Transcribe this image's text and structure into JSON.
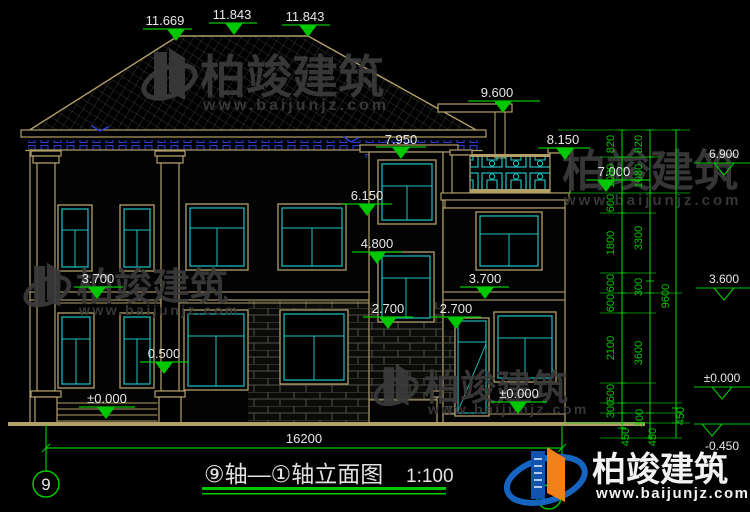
{
  "drawing": {
    "roof_marks": [
      "11.669",
      "11.843",
      "11.843"
    ],
    "elev": {
      "top_right": "9.600",
      "balcony_top": "8.150",
      "balcony_floor": "7.000",
      "tower_top": "7.950",
      "tower_win": "6.150",
      "tower_mid": "4.800",
      "left_floor2": "3.700",
      "wing_floor2": "3.700",
      "tower_sill": "2.700",
      "wing_sill": "2.700",
      "porch_cap": "0.500",
      "porch_zero": "±0.000",
      "wing_zero": "±0.000",
      "right_6900": "6.900",
      "right_3600": "3.600",
      "right_zero": "±0.000",
      "right_neg": "-0.450"
    },
    "chains": {
      "inner": [
        "820",
        "1080",
        "600",
        "1800",
        "600",
        "600",
        "2100",
        "600",
        "300",
        "450"
      ],
      "middle": [
        "820",
        "1080",
        "3300",
        "300",
        "3600",
        "300",
        "450"
      ],
      "outer_total": "9600",
      "outer_seg": "450"
    },
    "bottom": {
      "total_width": "16200",
      "axis_left": "9",
      "title": "⑨轴—①轴立面图",
      "scale": "1:100"
    }
  },
  "watermark": {
    "brand": "柏竣建筑",
    "url": "www.baijunjz.com"
  },
  "logo": {
    "brand": "柏竣建筑",
    "url": "www.baijunjz.com"
  },
  "colors": {
    "line_tan": "#b3a069",
    "line_cyan": "#1fc4c4",
    "line_green": "#00c800",
    "dentil_blue": "#2a3fd0",
    "logo_blue": "#1565c0",
    "logo_orange": "#f08019"
  }
}
